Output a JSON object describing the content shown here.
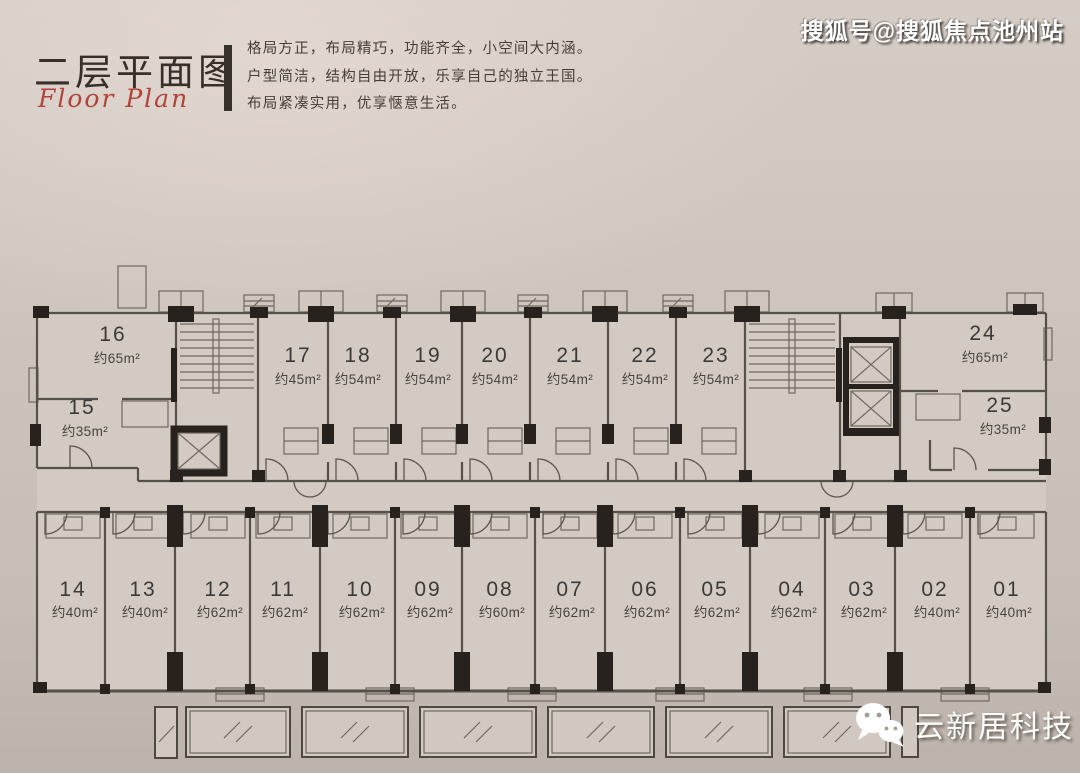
{
  "header": {
    "title": "二层平面图",
    "subtitle": "Floor Plan",
    "description_lines": [
      "格局方正，布局精巧，功能齐全，小空间大内涵。",
      "户型简洁，结构自由开放，乐享自己的独立王国。",
      "布局紧凑实用，优享惬意生活。"
    ]
  },
  "watermarks": {
    "top_right": "搜狐号@搜狐焦点池州站",
    "bottom_right": "云新居科技"
  },
  "floor_plan": {
    "top_units": [
      {
        "no": "16",
        "area": "约65m²"
      },
      {
        "no": "15",
        "area": "约35m²"
      },
      {
        "no": "17",
        "area": "约45m²"
      },
      {
        "no": "18",
        "area": "约54m²"
      },
      {
        "no": "19",
        "area": "约54m²"
      },
      {
        "no": "20",
        "area": "约54m²"
      },
      {
        "no": "21",
        "area": "约54m²"
      },
      {
        "no": "22",
        "area": "约54m²"
      },
      {
        "no": "23",
        "area": "约54m²"
      },
      {
        "no": "24",
        "area": "约65m²"
      },
      {
        "no": "25",
        "area": "约35m²"
      }
    ],
    "bottom_units": [
      {
        "no": "14",
        "area": "约40m²"
      },
      {
        "no": "13",
        "area": "约40m²"
      },
      {
        "no": "12",
        "area": "约62m²"
      },
      {
        "no": "11",
        "area": "约62m²"
      },
      {
        "no": "10",
        "area": "约62m²"
      },
      {
        "no": "09",
        "area": "约62m²"
      },
      {
        "no": "08",
        "area": "约60m²"
      },
      {
        "no": "07",
        "area": "约62m²"
      },
      {
        "no": "06",
        "area": "约62m²"
      },
      {
        "no": "05",
        "area": "约62m²"
      },
      {
        "no": "04",
        "area": "约62m²"
      },
      {
        "no": "03",
        "area": "约62m²"
      },
      {
        "no": "02",
        "area": "约40m²"
      },
      {
        "no": "01",
        "area": "约40m²"
      }
    ]
  },
  "colors": {
    "accent_red": "#b2433b",
    "paper": "#cdc5bd",
    "ink": "#56504a",
    "black_fill": "#27221d"
  }
}
